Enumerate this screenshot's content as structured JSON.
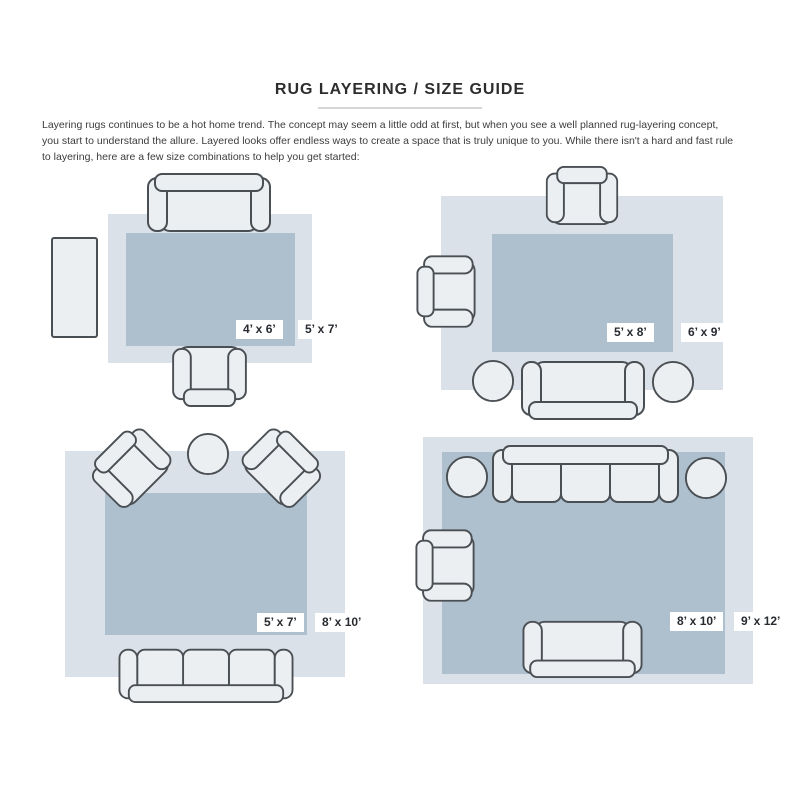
{
  "page": {
    "title": "RUG LAYERING / SIZE GUIDE",
    "intro_lines": [
      "Layering rugs continues to be a hot home trend. The concept may seem a little odd at first, but when you see a well planned rug-layering concept,",
      "you start to understand the allure. Layered looks offer endless ways to create a space that is truly unique to you. While there isn't a hard and fast rule",
      "to layering, here are a few size combinations to help you get started:"
    ]
  },
  "colors": {
    "outer_rug": "#dbe1e8",
    "inner_rug": "#aec0ce",
    "furniture_fill": "#eceff2",
    "furniture_stroke": "#4a4f54",
    "title_text": "#2d2d2d",
    "body_text": "#3c3c3c",
    "label_text": "#272b30",
    "divider": "#d6d6d6"
  },
  "layouts": [
    {
      "name": "5x7 layered over 4x6",
      "inner_label": "4’ x 6’",
      "outer_label": "5’ x 7’",
      "furniture": [
        "loveseat-sofa",
        "side-table",
        "armchair"
      ]
    },
    {
      "name": "6x9 layered over 5x8",
      "inner_label": "5’ x 8’",
      "outer_label": "6’ x 9’",
      "furniture": [
        "armchair",
        "armchair",
        "loveseat-sofa",
        "round-pouf",
        "round-pouf"
      ]
    },
    {
      "name": "8x10 layered over 5x7",
      "inner_label": "5’ x 7’",
      "outer_label": "8’ x 10’",
      "furniture": [
        "armchair",
        "armchair",
        "round-table",
        "three-seat-sofa"
      ]
    },
    {
      "name": "9x12 layered over 8x10",
      "inner_label": "8’ x 10’",
      "outer_label": "9’ x 12’",
      "furniture": [
        "three-seat-sofa",
        "round-pouf",
        "round-pouf",
        "armchair",
        "loveseat-sofa"
      ]
    }
  ]
}
